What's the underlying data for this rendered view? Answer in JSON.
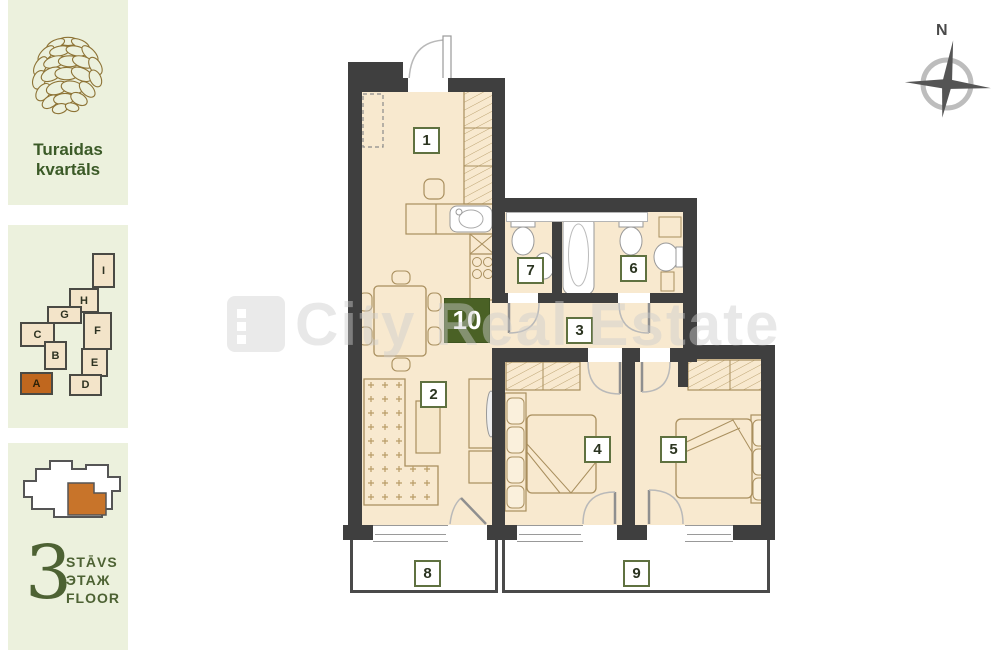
{
  "project": {
    "title_line1": "Turaidas",
    "title_line2": "kvartāls"
  },
  "building_map": {
    "blocks": [
      {
        "letter": "I",
        "x": 92,
        "y": 253,
        "w": 19,
        "h": 31,
        "highlight": false
      },
      {
        "letter": "H",
        "x": 69,
        "y": 288,
        "w": 26,
        "h": 21,
        "highlight": false
      },
      {
        "letter": "G",
        "x": 47,
        "y": 306,
        "w": 31,
        "h": 14,
        "highlight": false
      },
      {
        "letter": "C",
        "x": 20,
        "y": 322,
        "w": 31,
        "h": 21,
        "highlight": false
      },
      {
        "letter": "B",
        "x": 44,
        "y": 341,
        "w": 19,
        "h": 25,
        "highlight": false
      },
      {
        "letter": "F",
        "x": 83,
        "y": 312,
        "w": 25,
        "h": 34,
        "highlight": false
      },
      {
        "letter": "E",
        "x": 81,
        "y": 348,
        "w": 23,
        "h": 25,
        "highlight": false
      },
      {
        "letter": "D",
        "x": 69,
        "y": 374,
        "w": 29,
        "h": 18,
        "highlight": false
      },
      {
        "letter": "A",
        "x": 20,
        "y": 372,
        "w": 29,
        "h": 19,
        "highlight": true
      }
    ]
  },
  "floor": {
    "number": "3",
    "labels": [
      "STĀVS",
      "ЭТАЖ",
      "FLOOR"
    ]
  },
  "compass": {
    "north_label": "N"
  },
  "watermark": {
    "text": "City Real Estate"
  },
  "floorplan": {
    "rooms": [
      {
        "number": "1",
        "x": 413,
        "y": 127,
        "highlight": false
      },
      {
        "number": "2",
        "x": 420,
        "y": 381,
        "highlight": false
      },
      {
        "number": "3",
        "x": 566,
        "y": 317,
        "highlight": false
      },
      {
        "number": "4",
        "x": 584,
        "y": 436,
        "highlight": false
      },
      {
        "number": "5",
        "x": 660,
        "y": 436,
        "highlight": false
      },
      {
        "number": "6",
        "x": 620,
        "y": 255,
        "highlight": false
      },
      {
        "number": "7",
        "x": 517,
        "y": 257,
        "highlight": false
      },
      {
        "number": "8",
        "x": 414,
        "y": 560,
        "highlight": false
      },
      {
        "number": "9",
        "x": 623,
        "y": 560,
        "highlight": false
      },
      {
        "number": "10",
        "x": 444,
        "y": 298,
        "highlight": true
      }
    ],
    "colors": {
      "wall": "#3f3f3f",
      "room_fill": "#f8e9cf",
      "label_green": "#5f7140",
      "highlight_green": "#4a6125",
      "accent_orange": "#c0671e",
      "panel_bg": "#ecf1dd",
      "title_green": "#3b5a27"
    }
  }
}
